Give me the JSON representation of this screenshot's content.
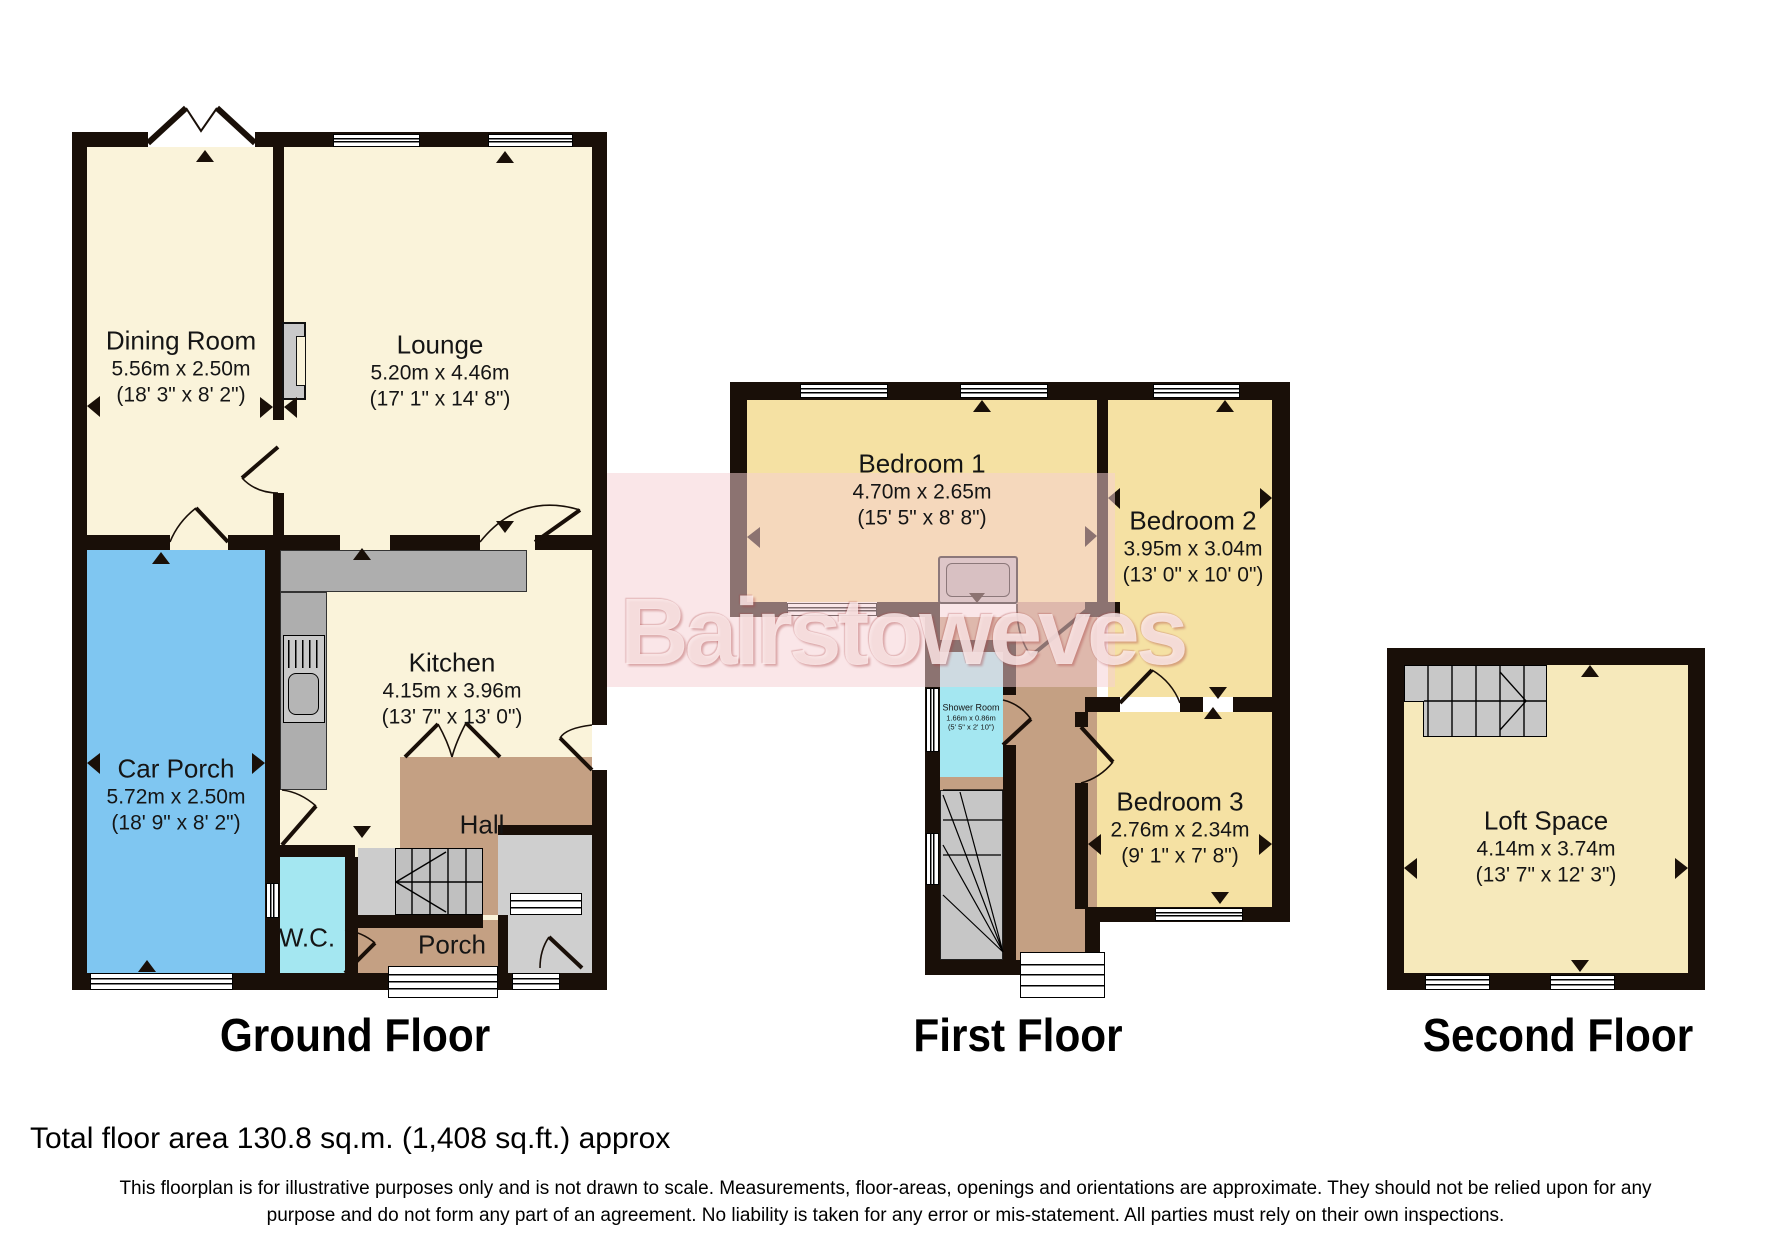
{
  "watermark": {
    "text": "Bairstoweves",
    "band_color": "#F5D0D3"
  },
  "palette": {
    "wall": "#190F08",
    "cream_room": "#FAF3DA",
    "bedroom_tan": "#F5E1A3",
    "loft_yellow": "#F6E9BB",
    "car_porch_blue": "#7FC6F1",
    "wet_room_cyan": "#A4E7F1",
    "hall_brown": "#C4A083",
    "stairs_gray": "#C0C0C0"
  },
  "floors": [
    {
      "id": "ground",
      "title": "Ground Floor",
      "rooms": [
        {
          "name": "Dining Room",
          "metric": "5.56m x 2.50m",
          "imperial": "(18' 3\" x 8' 2\")"
        },
        {
          "name": "Lounge",
          "metric": "5.20m x 4.46m",
          "imperial": "(17' 1\" x 14' 8\")"
        },
        {
          "name": "Kitchen",
          "metric": "4.15m x 3.96m",
          "imperial": "(13' 7\" x 13' 0\")"
        },
        {
          "name": "Car Porch",
          "metric": "5.72m x 2.50m",
          "imperial": "(18' 9\" x 8' 2\")"
        },
        {
          "name": "Hall"
        },
        {
          "name": "W.C."
        },
        {
          "name": "Porch"
        }
      ]
    },
    {
      "id": "first",
      "title": "First Floor",
      "rooms": [
        {
          "name": "Bedroom 1",
          "metric": "4.70m x 2.65m",
          "imperial": "(15' 5\" x 8' 8\")"
        },
        {
          "name": "Bedroom 2",
          "metric": "3.95m x 3.04m",
          "imperial": "(13' 0\" x 10' 0\")"
        },
        {
          "name": "Bedroom 3",
          "metric": "2.76m x 2.34m",
          "imperial": "(9' 1\" x 7' 8\")"
        },
        {
          "name": "Shower Room",
          "metric": "1.66m x 0.86m",
          "imperial": "(5' 5\" x 2' 10\")"
        }
      ]
    },
    {
      "id": "second",
      "title": "Second Floor",
      "rooms": [
        {
          "name": "Loft Space",
          "metric": "4.14m x 3.74m",
          "imperial": "(13' 7\" x 12' 3\")"
        }
      ]
    }
  ],
  "footer": {
    "total_area": "Total floor area 130.8 sq.m. (1,408 sq.ft.) approx",
    "disclaimer_line1": "This floorplan is for illustrative purposes only and is not drawn to scale. Measurements, floor-areas, openings and orientations are approximate. They should not be relied upon for any",
    "disclaimer_line2": "purpose and do not form any part of an agreement. No liability is taken for any error or mis-statement. All parties must rely on their own inspections."
  }
}
